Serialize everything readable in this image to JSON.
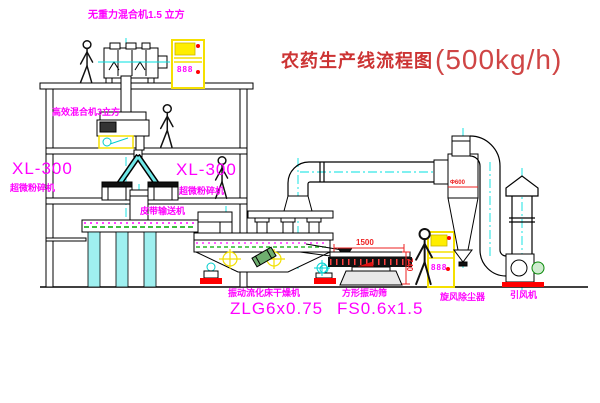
{
  "title": {
    "name": "农药生产线流程图",
    "capacity": "(500kg/h)"
  },
  "labels": {
    "gravity_free_mixer": "无重力混合机1.5 立方",
    "high_eff_mixer": "高效混合机3立方",
    "mill_left_model": "XL-300",
    "mill_left_name": "超微粉碎机",
    "mill_center_model": "XL-300",
    "mill_center_name": "超微粉碎机",
    "belt_conveyor": "皮带输送机",
    "dryer_name": "振动流化床干燥机",
    "dryer_model": "ZLG6x0.75",
    "sieve_name": "方形振动筛",
    "sieve_model": "FS0.6x1.5",
    "cyclone": "旋风除尘器",
    "fan": "引风机"
  },
  "dimensions": {
    "sieve_length": "1500",
    "sieve_height": "740",
    "cyclone_diameter": "Φ600"
  },
  "panels": {
    "panel1_display": "888",
    "panel2_display": "888"
  },
  "colors": {
    "label_magenta": "#ff00ff",
    "title_red": "#cc3333",
    "dimension_red": "#ee2222",
    "centerline_cyan": "#00e0e0",
    "cabinet_yellow": "#ffff00",
    "hatch_green": "#00aa00",
    "line_black": "#000000",
    "background": "#ffffff"
  }
}
